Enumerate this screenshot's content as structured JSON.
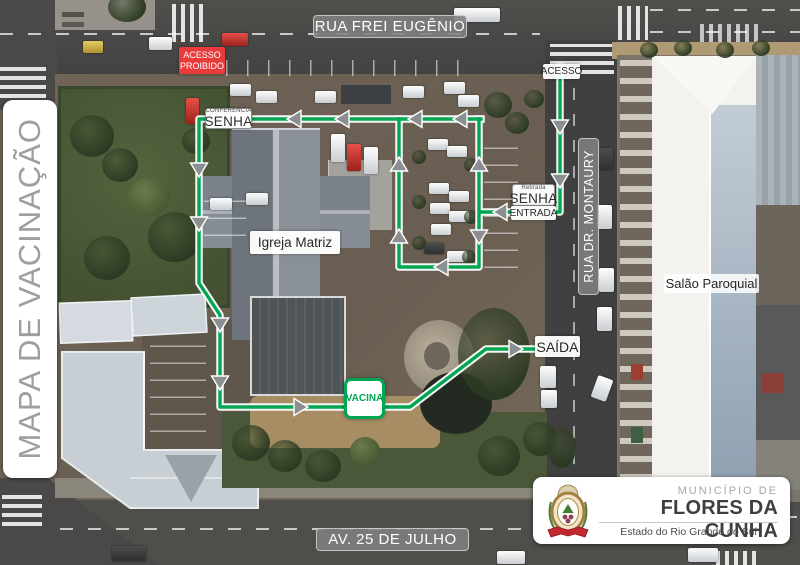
{
  "banner_title": "MAPA DE VACINAÇÃO",
  "streets": {
    "top": "RUA FREI EUGÊNIO",
    "right": "RUA DR. MONTAURY",
    "bottom": "AV. 25 DE JULHO"
  },
  "route_labels": {
    "acesso": "ACESSO",
    "acesso_proibido_line1": "ACESSO",
    "acesso_proibido_line2": "PROIBIDO",
    "conferencia_small": "CONFERÊNCIA",
    "conferencia_big": "SENHA",
    "retirada_small": "Retirada",
    "retirada_big": "SENHA",
    "entrada": "ENTRADA",
    "saida": "SAÍDA",
    "vacina": "VACINA"
  },
  "places": {
    "church": "Igreja Matriz",
    "parish_hall": "Salão Paroquial"
  },
  "logo": {
    "line1": "MUNICÍPIO DE",
    "line2": "FLORES DA CUNHA",
    "line3": "Estado do Rio Grande do Sul"
  },
  "colors": {
    "route_green": "#00a651",
    "prohibited_red": "#e83b3b",
    "street_label_bg": "#80807e"
  }
}
